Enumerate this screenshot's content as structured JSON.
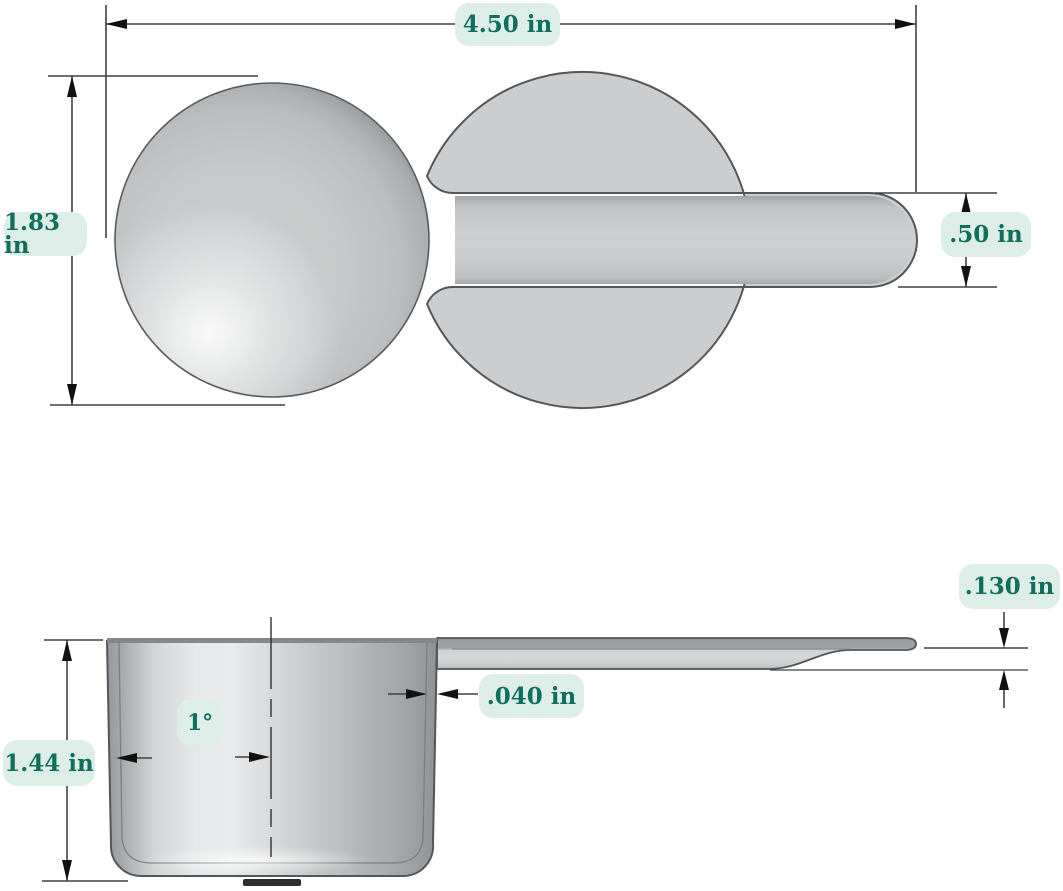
{
  "drawing": {
    "type": "technical-dimension-drawing",
    "subject": "measuring scoop",
    "views": [
      "top view",
      "side view"
    ]
  },
  "dimensions": {
    "total_length": {
      "value": "4.50 in"
    },
    "bowl_diameter": {
      "value": "1.83 in"
    },
    "handle_width": {
      "value": ".50 in"
    },
    "handle_thickness": {
      "value": ".130 in"
    },
    "wall_thickness": {
      "value": ".040 in"
    },
    "cup_height": {
      "value": "1.44 in"
    },
    "draft_angle": {
      "value": "1°"
    }
  },
  "colors": {
    "label_background": "#ddeee8",
    "label_text": "#0f6f5c",
    "dimension_line": "#3f4245",
    "part_outline": "#53565a",
    "part_fill": "#cbcdce",
    "background": "#ffffff"
  }
}
